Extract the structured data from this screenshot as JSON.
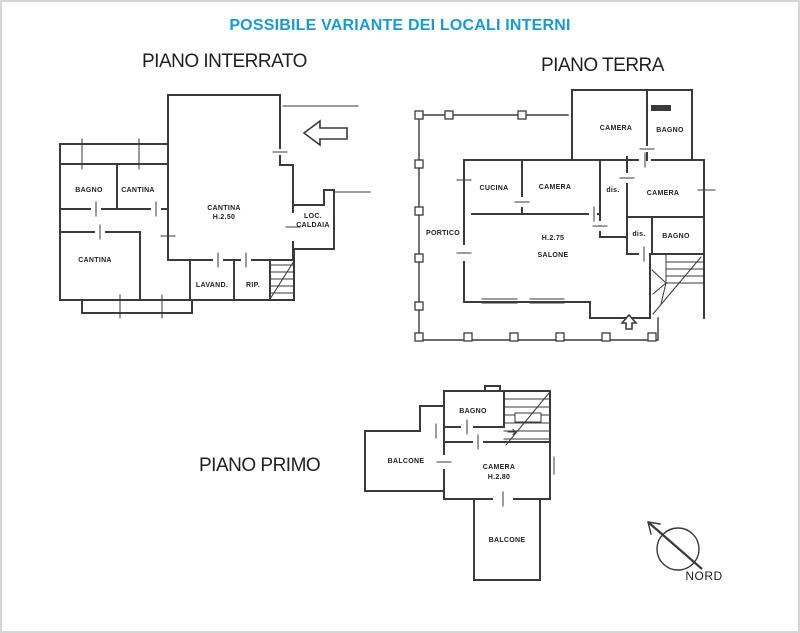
{
  "title": "POSSIBILE VARIANTE DEI LOCALI INTERNI",
  "colors": {
    "title": "#149bd9",
    "ink": "#3a3a3a"
  },
  "floors": {
    "interrato": {
      "heading": "PIANO INTERRATO",
      "rooms": {
        "bagno": "BAGNO",
        "cantina_top": "CANTINA",
        "cantina_left": "CANTINA",
        "cantina_main": "CANTINA",
        "cantina_main_height": "H.2.50",
        "loc_caldaia_1": "LOC.",
        "loc_caldaia_2": "CALDAIA",
        "lavanderia": "LAVAND.",
        "ripostiglio": "RIP."
      }
    },
    "terra": {
      "heading": "PIANO TERRA",
      "rooms": {
        "camera_nord": "CAMERA",
        "bagno_nord": "BAGNO",
        "cucina": "CUCINA",
        "camera_centro": "CAMERA",
        "dis_centro": "dis.",
        "camera_est": "CAMERA",
        "portico": "PORTICO",
        "salone_height": "H.2.75",
        "salone": "SALONE",
        "dis_est": "dis.",
        "bagno_est": "BAGNO"
      }
    },
    "primo": {
      "heading": "PIANO PRIMO",
      "rooms": {
        "bagno": "BAGNO",
        "balcone_ovest": "BALCONE",
        "camera": "CAMERA",
        "camera_height": "H.2.80",
        "balcone_sud": "BALCONE"
      }
    }
  },
  "compass": {
    "label": "NORD"
  }
}
